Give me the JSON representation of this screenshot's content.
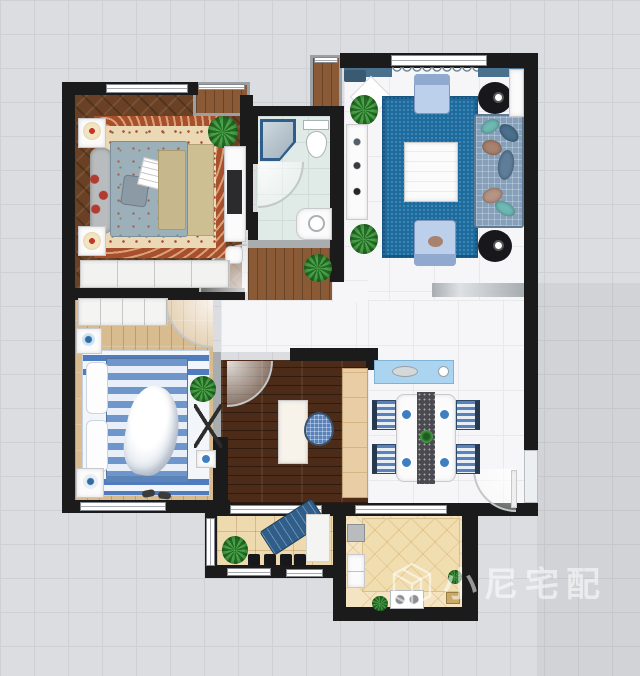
{
  "watermark": {
    "icon": "cube-logo-icon",
    "text": "小尼宅配"
  },
  "palette": {
    "background": "#dcdde0",
    "grid_line": "#cfd0d4",
    "wall": "#1b1b1b",
    "tile_floor": "#f6f6f8",
    "master_bedroom_floor": "#6a4124",
    "second_bedroom_floor": "#d9bb90",
    "study_floor": "#4c2c18",
    "hall_nook_floor": "#8a5a36",
    "bathroom_floor": "#e0eae6",
    "kitchen_floor": "#f4e4c2",
    "balcony_floor": "#eedaaf",
    "living_rug": "#1d6ca0",
    "master_rug_border": "#a8502e",
    "master_rug_field": "#ead9b4",
    "sofa": "#87a0ba",
    "armchair": "#bcd0ec",
    "master_bed": "#9cb0ba",
    "blue_bed_stripe": "#6f96cb",
    "dining_sideboard": "#aad4ef",
    "kitchen_counter": "#f0ddb0",
    "plant_green": "#2e8b2e"
  }
}
